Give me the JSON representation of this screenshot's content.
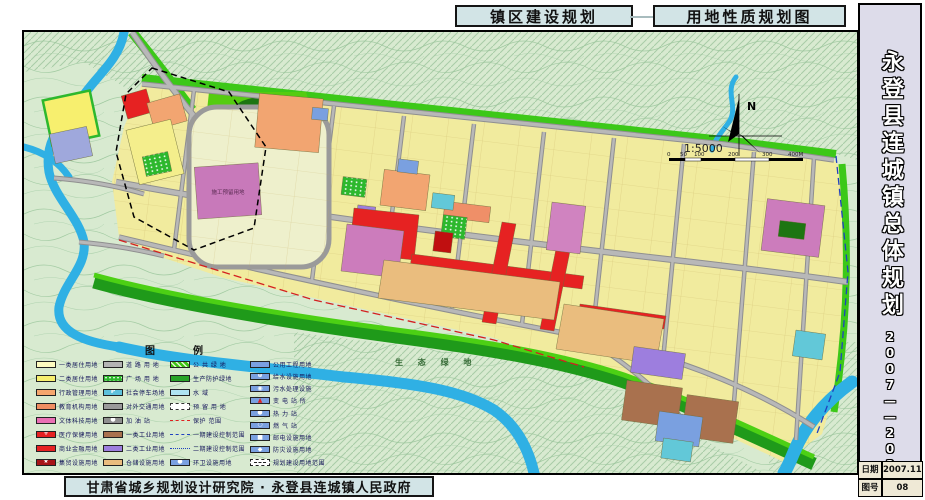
{
  "header": {
    "title_left": "镇区建设规划",
    "title_right": "用地性质规划图"
  },
  "titleblock": {
    "project": "永登县连城镇总体规划",
    "years": "2007——2020",
    "rows": [
      {
        "label": "日期",
        "value": "2007.11"
      },
      {
        "label": "图号",
        "value": "08"
      }
    ]
  },
  "footer": {
    "credit": "甘肃省城乡规划设计研究院 · 永登县连城镇人民政府"
  },
  "map": {
    "north_label": "N",
    "scale_text": "1:5000",
    "scalebar": [
      "0",
      "50",
      "100",
      "200",
      "300",
      "400M"
    ],
    "labels": {
      "eco_green": "生 态 绿 地",
      "reserved_block": "施工预留用地"
    }
  },
  "legend": {
    "title": "图　例",
    "columns": [
      {
        "items": [
          {
            "label": "一类居住用地",
            "sw": {
              "t": "solid",
              "c": "#fdfbc0"
            }
          },
          {
            "label": "二类居住用地",
            "sw": {
              "t": "solid",
              "c": "#f7ef6e"
            }
          },
          {
            "label": "行政管理用地",
            "sw": {
              "t": "solid",
              "c": "#f5a66e"
            }
          },
          {
            "label": "教育机构用地",
            "sw": {
              "t": "solid",
              "c": "#f08d62"
            }
          },
          {
            "label": "文体科技用地",
            "sw": {
              "t": "solid",
              "c": "#ea6fb4"
            }
          },
          {
            "label": "医疗保健用地",
            "sw": {
              "t": "solid",
              "c": "#e62222",
              "g": "+",
              "gc": "#ffffff"
            }
          },
          {
            "label": "商业金融用地",
            "sw": {
              "t": "solid",
              "c": "#e62222"
            }
          },
          {
            "label": "集贸设施用地",
            "sw": {
              "t": "solid",
              "c": "#a81418",
              "g": "★",
              "gc": "#ffffff"
            }
          }
        ]
      },
      {
        "items": [
          {
            "label": "道 路 用 地",
            "sw": {
              "t": "solid",
              "c": "#b4b4b4"
            }
          },
          {
            "label": "广 场 用 地",
            "sw": {
              "t": "dots",
              "c": "#2db82d"
            }
          },
          {
            "label": "社会停车场地",
            "sw": {
              "t": "solid",
              "c": "#5ec1dc",
              "g": "P",
              "gc": "#ffffff"
            }
          },
          {
            "label": "对外交通用地",
            "sw": {
              "t": "solid",
              "c": "#9a9a9a"
            }
          },
          {
            "label": "加  油  站",
            "sw": {
              "t": "solid",
              "c": "#8f8f8f",
              "g": "●",
              "gc": "#ffffff"
            }
          },
          {
            "label": "一类工业用地",
            "sw": {
              "t": "solid",
              "c": "#a9714e"
            }
          },
          {
            "label": "二类工业用地",
            "sw": {
              "t": "solid",
              "c": "#9d7ede"
            }
          },
          {
            "label": "仓储设施用地",
            "sw": {
              "t": "solid",
              "c": "#eabd7e"
            }
          }
        ]
      },
      {
        "items": [
          {
            "label": "公 共 绿 地",
            "sw": {
              "t": "hatch",
              "c": "#3bc214"
            }
          },
          {
            "label": "生产防护绿地",
            "sw": {
              "t": "solid",
              "c": "#28a428"
            }
          },
          {
            "label": "水        域",
            "sw": {
              "t": "solid",
              "c": "#aee4f2"
            }
          },
          {
            "label": "预 留 用 地",
            "sw": {
              "t": "dashbox",
              "c": "#ffffff"
            }
          },
          {
            "label": "保护  范围",
            "sw": {
              "t": "rline",
              "c": "#e02020"
            }
          },
          {
            "label": "一期建设控制范围",
            "sw": {
              "t": "bline",
              "c": "#2040c0"
            }
          },
          {
            "label": "二期建设控制范围",
            "sw": {
              "t": "bdash",
              "c": "#2040c0"
            }
          },
          {
            "label": "环卫设施用地",
            "sw": {
              "t": "solid",
              "c": "#7aa0e0",
              "g": "●",
              "gc": "#ffffff"
            }
          }
        ]
      },
      {
        "items": [
          {
            "label": "公用工程用地",
            "sw": {
              "t": "solid",
              "c": "#7aa0e0"
            }
          },
          {
            "label": "给水设施用地",
            "sw": {
              "t": "solid",
              "c": "#7aa0e0",
              "g": "⊕",
              "gc": "#ffffff"
            }
          },
          {
            "label": "污水处理设施",
            "sw": {
              "t": "solid",
              "c": "#7aa0e0",
              "g": "◉",
              "gc": "#ffffff"
            }
          },
          {
            "label": "变 电 站 所",
            "sw": {
              "t": "solid",
              "c": "#7aa0e0",
              "g": "▲",
              "gc": "#e02020"
            }
          },
          {
            "label": "热  力  站",
            "sw": {
              "t": "solid",
              "c": "#7aa0e0",
              "g": "●",
              "gc": "#ffffff"
            }
          },
          {
            "label": "燃  气  站",
            "sw": {
              "t": "solid",
              "c": "#7aa0e0",
              "g": "○",
              "gc": "#ffffff"
            }
          },
          {
            "label": "邮电设施用地",
            "sw": {
              "t": "solid",
              "c": "#7aa0e0",
              "g": "■",
              "gc": "#ffffff"
            }
          },
          {
            "label": "防灾设施用地",
            "sw": {
              "t": "solid",
              "c": "#7aa0e0",
              "g": "◆",
              "gc": "#ffffff"
            }
          },
          {
            "label": "规划建设用地范围",
            "sw": {
              "t": "bound",
              "c": "#ffffff"
            }
          }
        ]
      }
    ]
  },
  "colors": {
    "map_bg": "#d8ead0",
    "contour": "#a3cba3",
    "river": "#2fb0e4",
    "band_yellow": "#f1eb9e",
    "road_gray": "#b2b2b2",
    "green_public": "#3cc818",
    "green_protect": "#1f9a1a",
    "red_commercial": "#e62222",
    "mauve_reserved": "#c879ba",
    "orange_edu": "#f2a571",
    "tan_storage": "#eabd7e",
    "purple_industry": "#9d7ede",
    "blue_utility": "#7aa0e0",
    "title_bg": "#d2e4e6",
    "sidebar_bg": "#dddcea"
  }
}
